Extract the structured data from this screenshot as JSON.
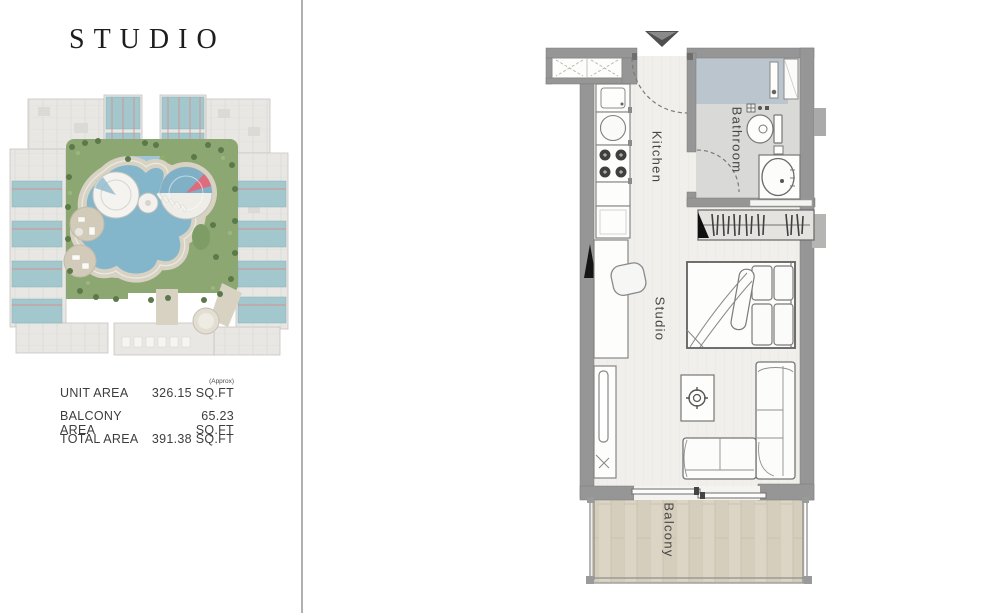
{
  "left_panel": {
    "title": "STUDIO",
    "area_table": {
      "rows": [
        {
          "label": "UNIT AREA",
          "note": "(Approx)",
          "value": "326.15 SQ.FT"
        },
        {
          "label": "BALCONY AREA",
          "note": "",
          "value": "65.23 SQ.FT"
        },
        {
          "label": "TOTAL AREA",
          "note": "",
          "value": "391.38 SQ.FT"
        }
      ]
    },
    "site_plan_colors": {
      "building": "#e9e7e3",
      "unit_highlight": "#a2c7cc",
      "marker_line": "#d98f8f",
      "landscape_green": "#8da773",
      "pool_blue": "#84b6cb",
      "deck_beige": "#d8d2c3"
    }
  },
  "floor_plan": {
    "room_labels": {
      "kitchen": "Kitchen",
      "bathroom": "Bathroom",
      "studio": "Studio",
      "balcony": "Balcony"
    },
    "colors": {
      "wall": "#969696",
      "floor": "#f0efeb",
      "bathroom_floor": "#d9d9d7",
      "shower": "#bac5cd",
      "balcony_wood": "#dcd4c4"
    }
  },
  "divider_color": "#b0b0b0"
}
